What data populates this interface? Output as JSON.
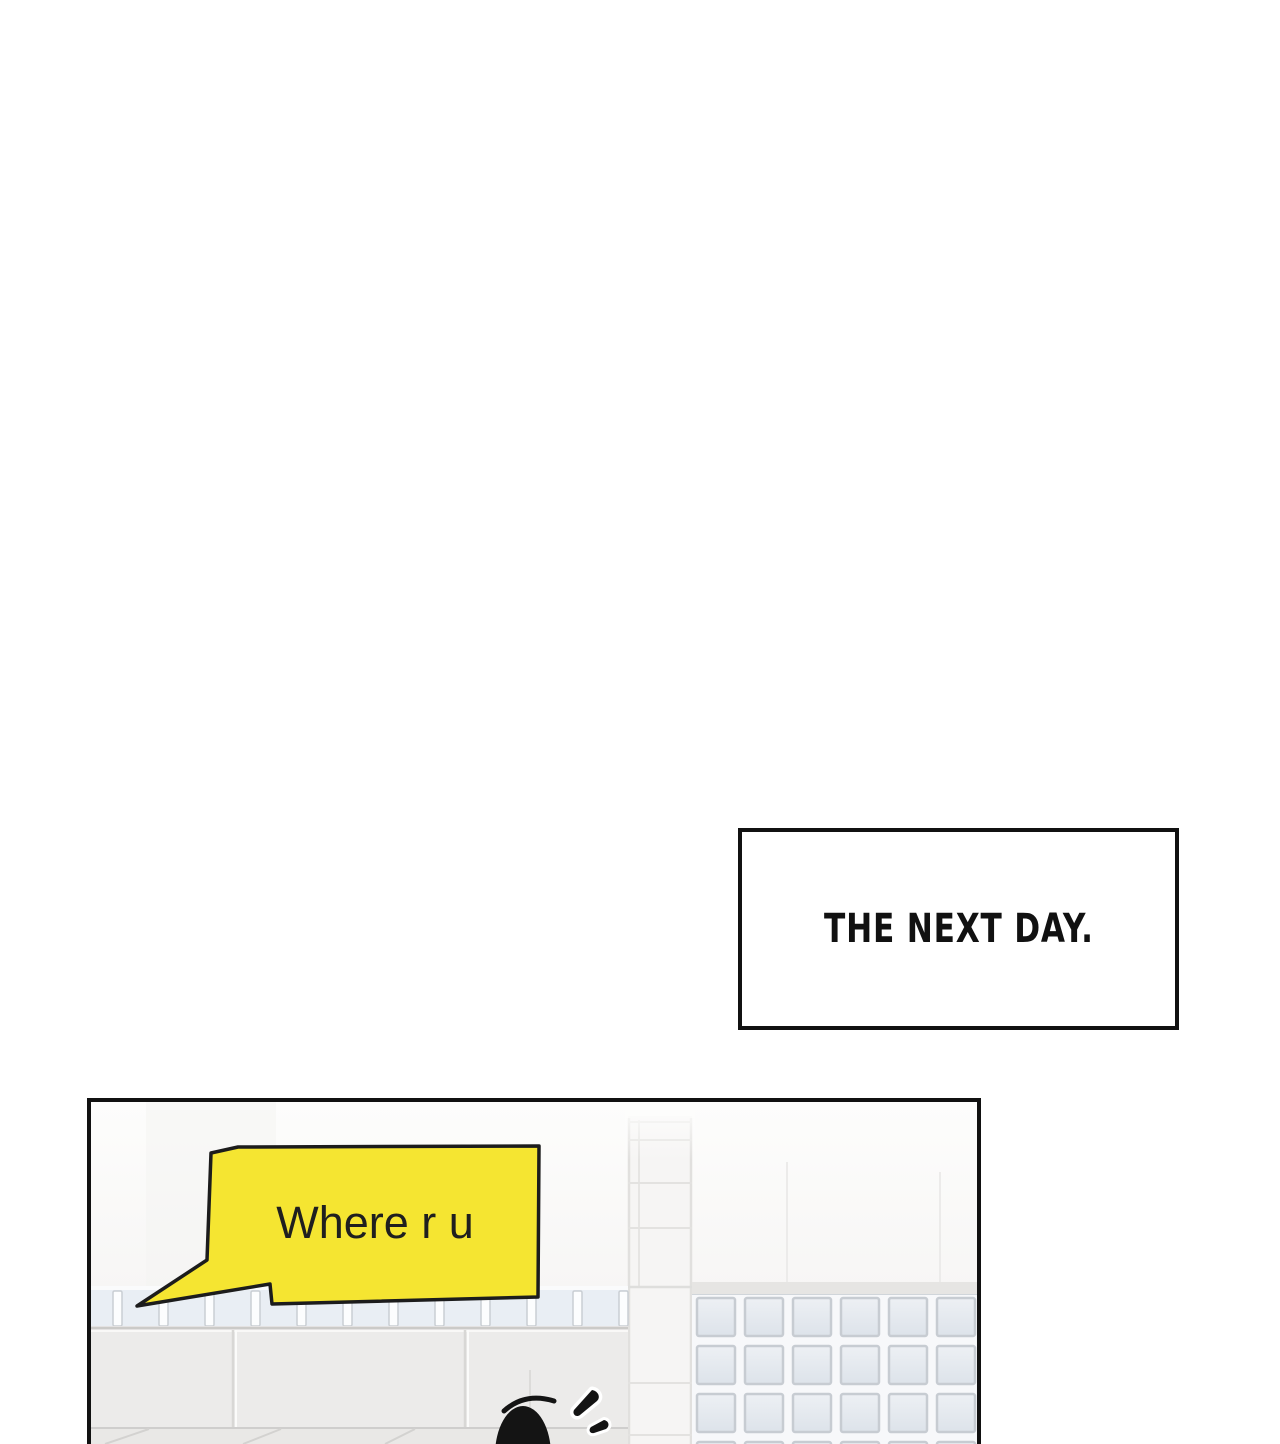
{
  "caption": {
    "text": "THE NEXT DAY."
  },
  "panel": {
    "bubble": {
      "text": "Where r u",
      "fill": "#f5e531",
      "outline": "#1c1c1c",
      "text_color": "#1f1f1f"
    }
  },
  "colors": {
    "page_bg": "#ffffff",
    "frame_ink": "#111111",
    "character_ink": "#141414"
  }
}
